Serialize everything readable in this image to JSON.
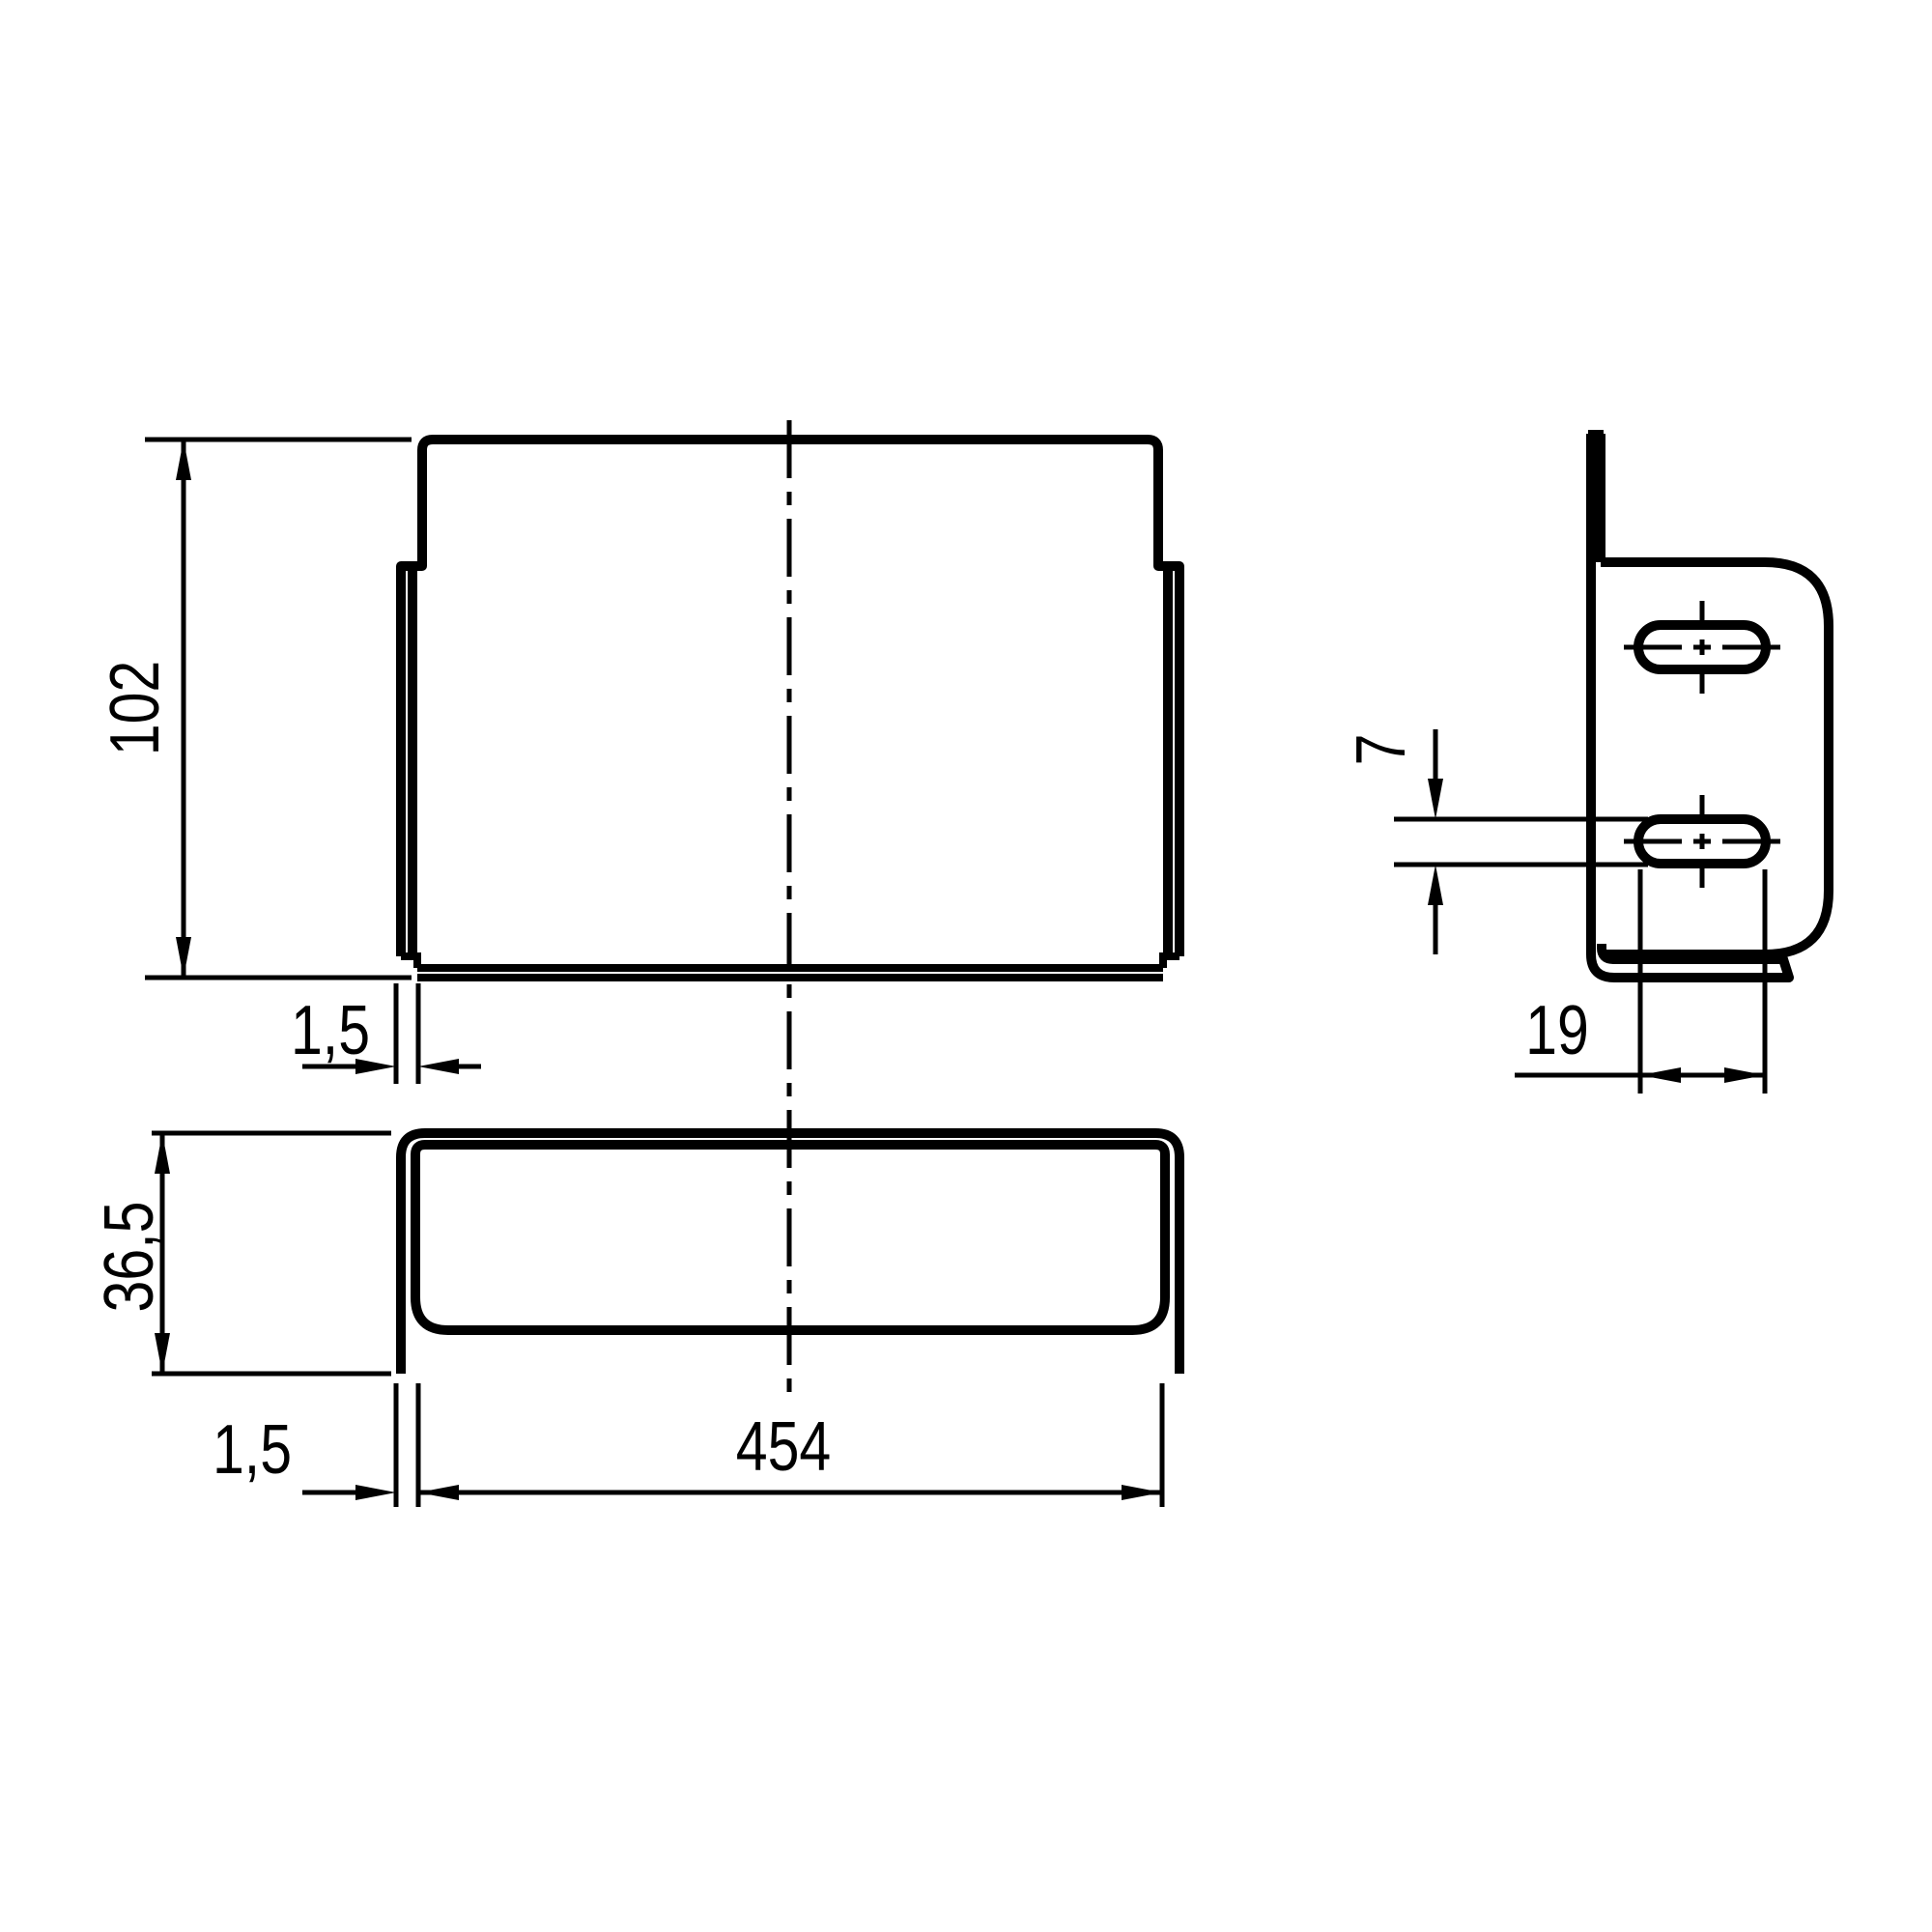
{
  "drawing": {
    "type": "technical-dimension-drawing",
    "background_color": "#ffffff",
    "line_color": "#000000",
    "dimensions": {
      "front_height": {
        "label": "102"
      },
      "front_thickness": {
        "label": "1,5"
      },
      "bottom_depth": {
        "label": "36,5"
      },
      "bottom_thickness": {
        "label": "1,5"
      },
      "bottom_width": {
        "label": "454"
      },
      "slot_width": {
        "label": "7"
      },
      "slot_spacing": {
        "label": "19"
      }
    }
  }
}
